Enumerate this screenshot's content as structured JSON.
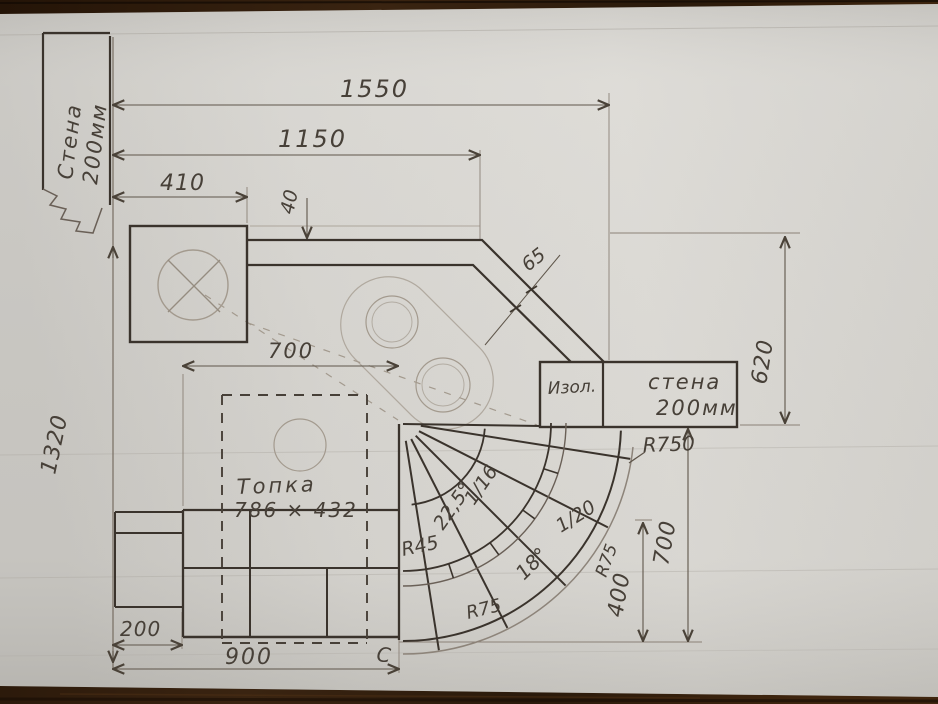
{
  "labels": {
    "left_wall": {
      "line1": "Стена",
      "line2": "200мм"
    },
    "wall_block": {
      "line1": "стена",
      "line2": "200мм"
    },
    "insulation": "Изол.",
    "firebox": {
      "line1": "Топка",
      "line2": "786 × 432"
    },
    "section_mark": "С"
  },
  "dims": {
    "total_width": "1550",
    "duct_width": "1150",
    "stove_width": "410",
    "gap": "40",
    "channel": "65",
    "right_height": "620",
    "left_height": "1320",
    "hearth_width": "700",
    "plinth_col": "200",
    "base_width": "900",
    "apron_depth": "700",
    "apron_inner": "400"
  },
  "radii": {
    "arc_outer": "R750",
    "arc_inner": "R45",
    "brick_left": "R75",
    "brick_right": "R75"
  },
  "angles": {
    "inner_sector": "22,5°",
    "outer_sector": "18°"
  },
  "ratios": {
    "wedge_small": "1/16",
    "wedge_large": "1/20"
  },
  "colors": {
    "paper": "#d7d5d0",
    "pencil_dark": "#3a332c",
    "pencil_medium": "#6a6057",
    "pencil_faint": "#a39a8e",
    "wood": "#33200f"
  }
}
